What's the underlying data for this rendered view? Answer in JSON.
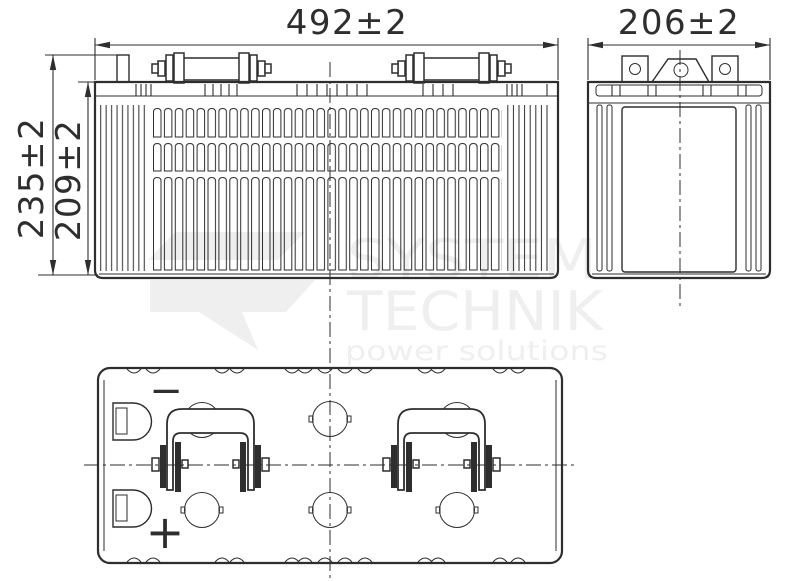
{
  "dimensions": {
    "front_width": "492±2",
    "side_depth": "206±2",
    "total_height": "235±2",
    "case_height": "209±2"
  },
  "polarity": {
    "negative": "−",
    "positive": "+"
  },
  "watermark": {
    "line1": "SYSTEM",
    "line2": "TECHNIK",
    "line3": "power solutions"
  },
  "colors": {
    "line": "#2e2e2e",
    "watermark": "#efefef",
    "background": "#ffffff"
  }
}
